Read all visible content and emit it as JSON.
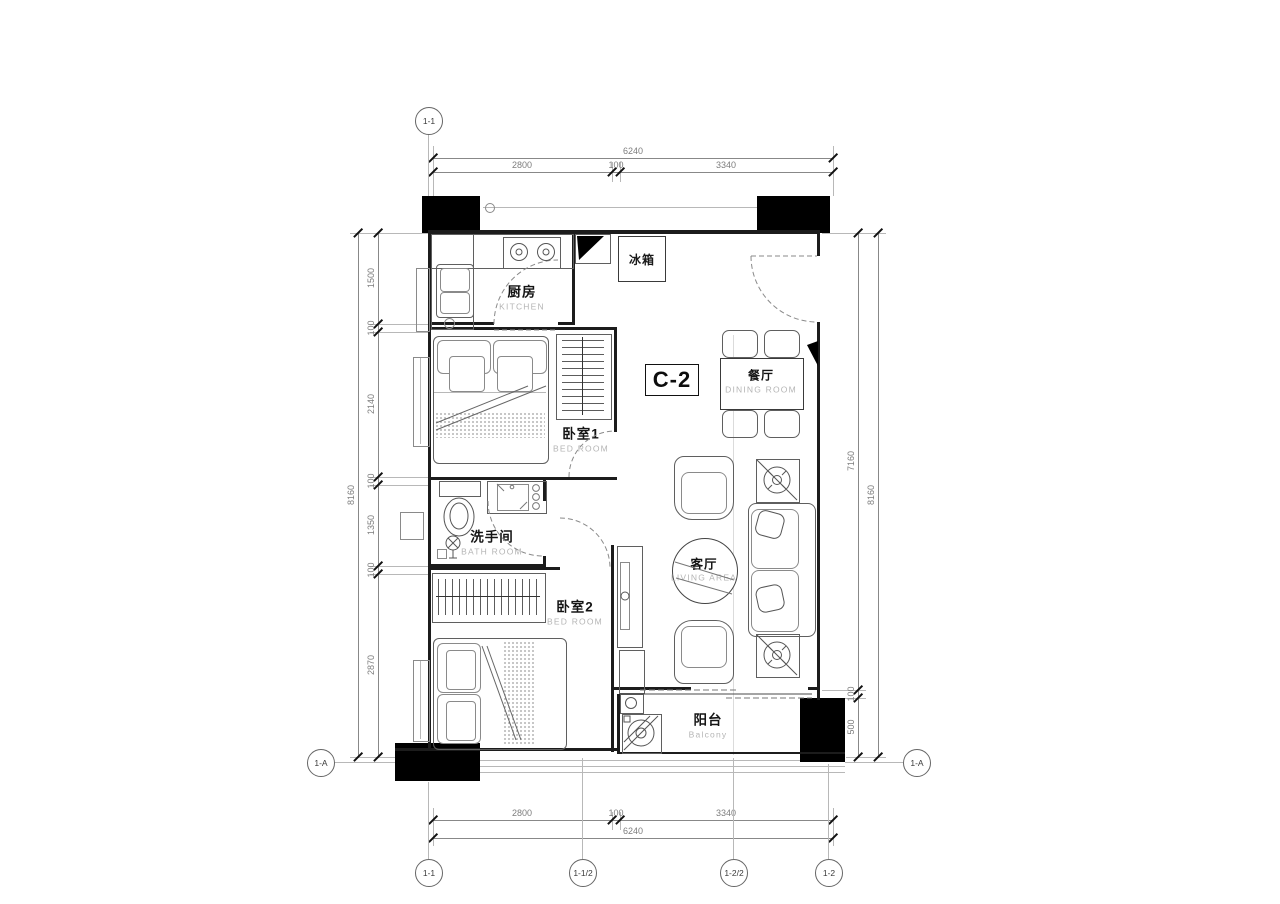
{
  "unit_label": "C-2",
  "rooms": {
    "kitchen": {
      "cn": "厨房",
      "en": "KITCHEN"
    },
    "bedroom1": {
      "cn": "卧室1",
      "en": "BED ROOM"
    },
    "bathroom": {
      "cn": "洗手间",
      "en": "BATH ROOM"
    },
    "bedroom2": {
      "cn": "卧室2",
      "en": "BED ROOM"
    },
    "dining": {
      "cn": "餐厅",
      "en": "DINING ROOM"
    },
    "living": {
      "cn": "客厅",
      "en": "LIVING AREA"
    },
    "balcony": {
      "cn": "阳台",
      "en": "Balcony"
    },
    "fridge": {
      "cn": "冰箱"
    }
  },
  "dims": {
    "top": {
      "total": "6240",
      "segments": [
        "2800",
        "100",
        "3340"
      ]
    },
    "bottom": {
      "total": "6240",
      "segments": [
        "2800",
        "100",
        "3340"
      ]
    },
    "left": {
      "total": "8160",
      "segments": [
        "1500",
        "100",
        "2140",
        "100",
        "1350",
        "100",
        "2870"
      ]
    },
    "right": {
      "total": "8160",
      "segments": [
        "7160",
        "100",
        "500"
      ]
    }
  },
  "grid": {
    "top": [
      "1-1"
    ],
    "bottom": [
      "1-1",
      "1-1/2",
      "1-2/2",
      "1-2"
    ],
    "left": [
      "1-A"
    ],
    "right": [
      "1-A"
    ]
  },
  "colors": {
    "wall": "#1c1c1c",
    "column": "#000000",
    "dim_text": "#7d7d7d",
    "en_text": "#b5b5b5"
  }
}
